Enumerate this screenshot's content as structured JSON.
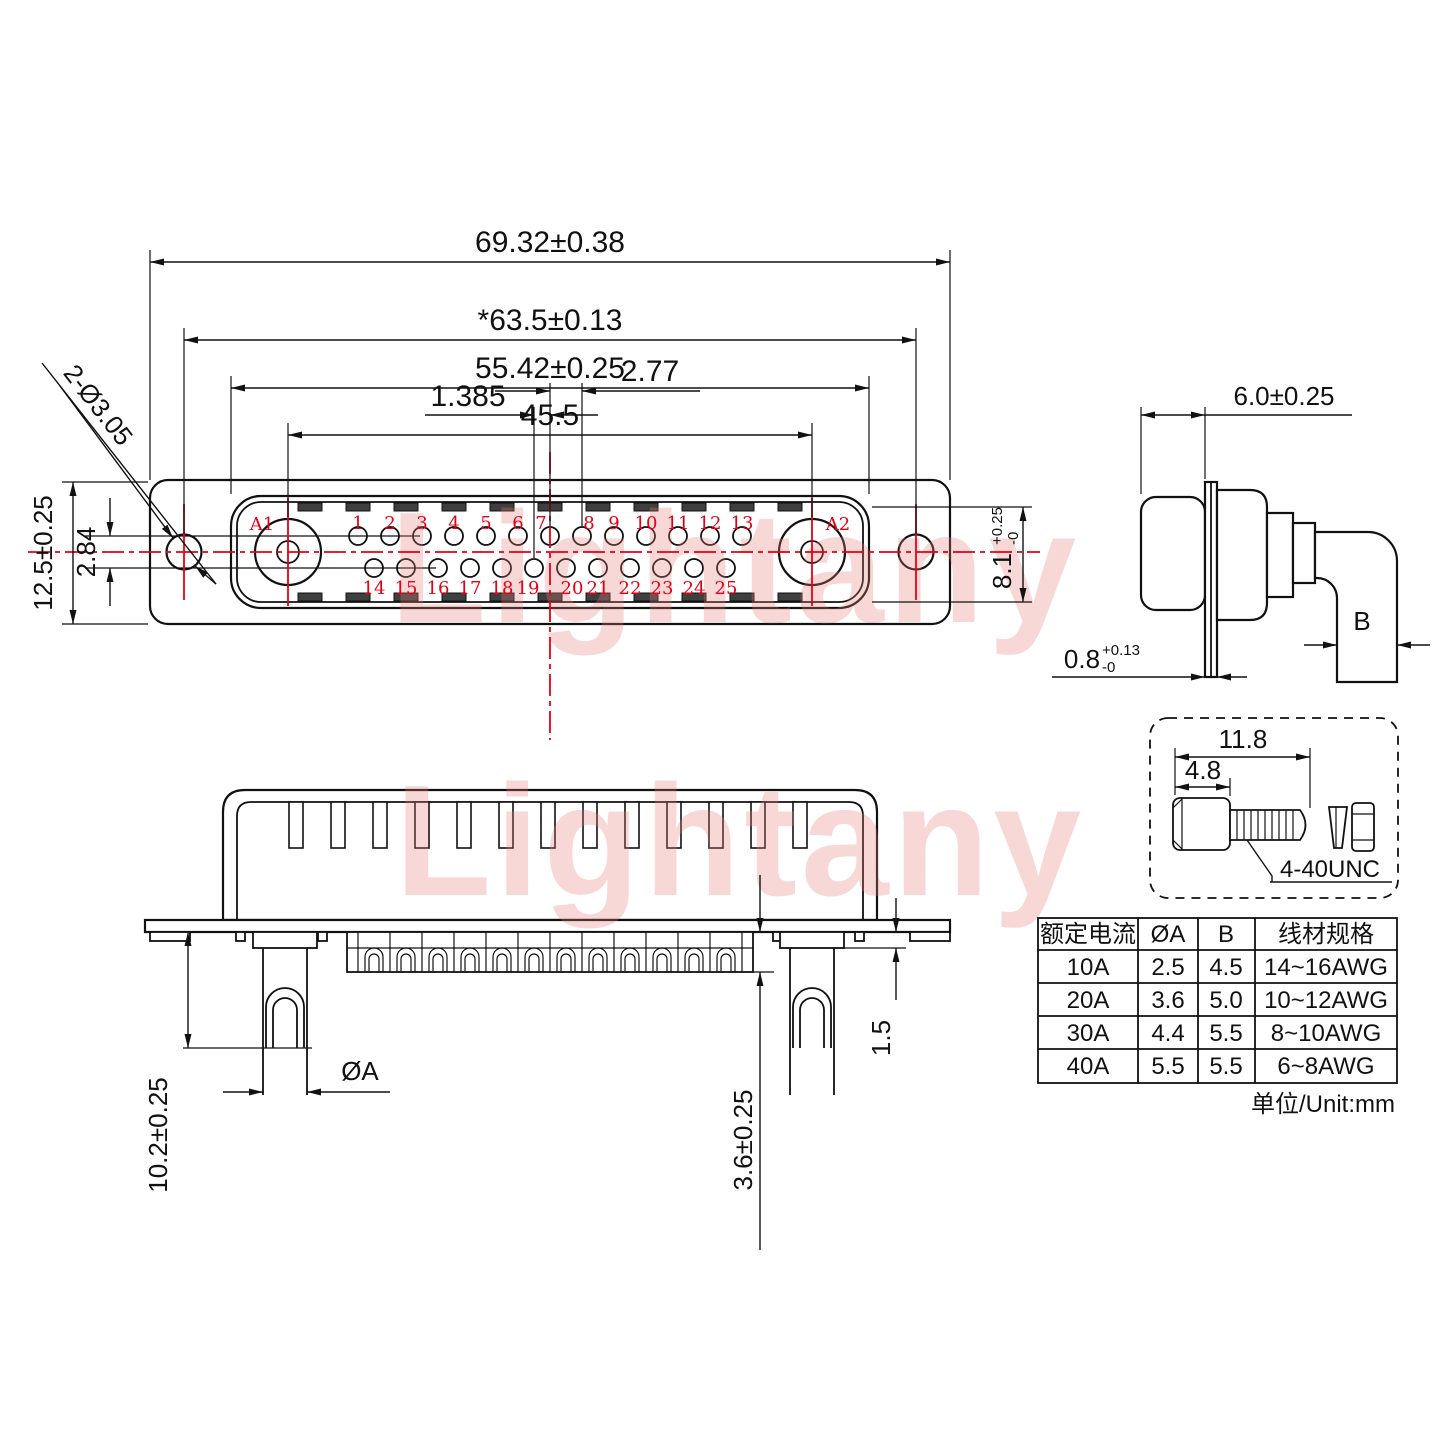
{
  "watermark": "Lightany",
  "front_view": {
    "dims": {
      "overall_width": "69.32±0.38",
      "mount_hole_span": "*63.5±0.13",
      "shell_width": "55.42±0.25",
      "power_pin_span": "45.5",
      "pin_pitch": "2.77",
      "row_stagger": "1.385",
      "flange_height": "12.5±0.25",
      "row_gap": "2.84",
      "mount_hole_callout": "2-Ø3.05",
      "shell_height": "8.1",
      "shell_height_tol_plus": "+0.25",
      "shell_height_tol_minus": "-0"
    },
    "pins": {
      "a_labels": [
        "A1",
        "A2"
      ],
      "top_row": [
        "1",
        "2",
        "3",
        "4",
        "5",
        "6",
        "7",
        "8",
        "9",
        "10",
        "11",
        "12",
        "13"
      ],
      "bottom_row": [
        "14",
        "15",
        "16",
        "17",
        "18",
        "19",
        "20",
        "21",
        "22",
        "23",
        "24",
        "25"
      ]
    }
  },
  "side_view": {
    "dims": {
      "shell_depth": "6.0±0.25",
      "terminal_width": "B",
      "flange_thickness": "0.8",
      "flange_tol_plus": "+0.13",
      "flange_tol_minus": "-0"
    }
  },
  "bottom_view": {
    "dims": {
      "pin_length": "10.2±0.25",
      "pin_diameter": "ØA",
      "cup_depth": "3.6±0.25",
      "shoulder": "1.5"
    }
  },
  "screw_detail": {
    "dims": {
      "total_length": "11.8",
      "head_length": "4.8"
    },
    "thread_label": "4-40UNC"
  },
  "spec_table": {
    "headers": [
      "额定电流",
      "ØA",
      "B",
      "线材规格"
    ],
    "rows": [
      [
        "10A",
        "2.5",
        "4.5",
        "14~16AWG"
      ],
      [
        "20A",
        "3.6",
        "5.0",
        "10~12AWG"
      ],
      [
        "30A",
        "4.4",
        "5.5",
        "8~10AWG"
      ],
      [
        "40A",
        "5.5",
        "5.5",
        "6~8AWG"
      ]
    ],
    "unit_note": "单位/Unit:mm"
  }
}
